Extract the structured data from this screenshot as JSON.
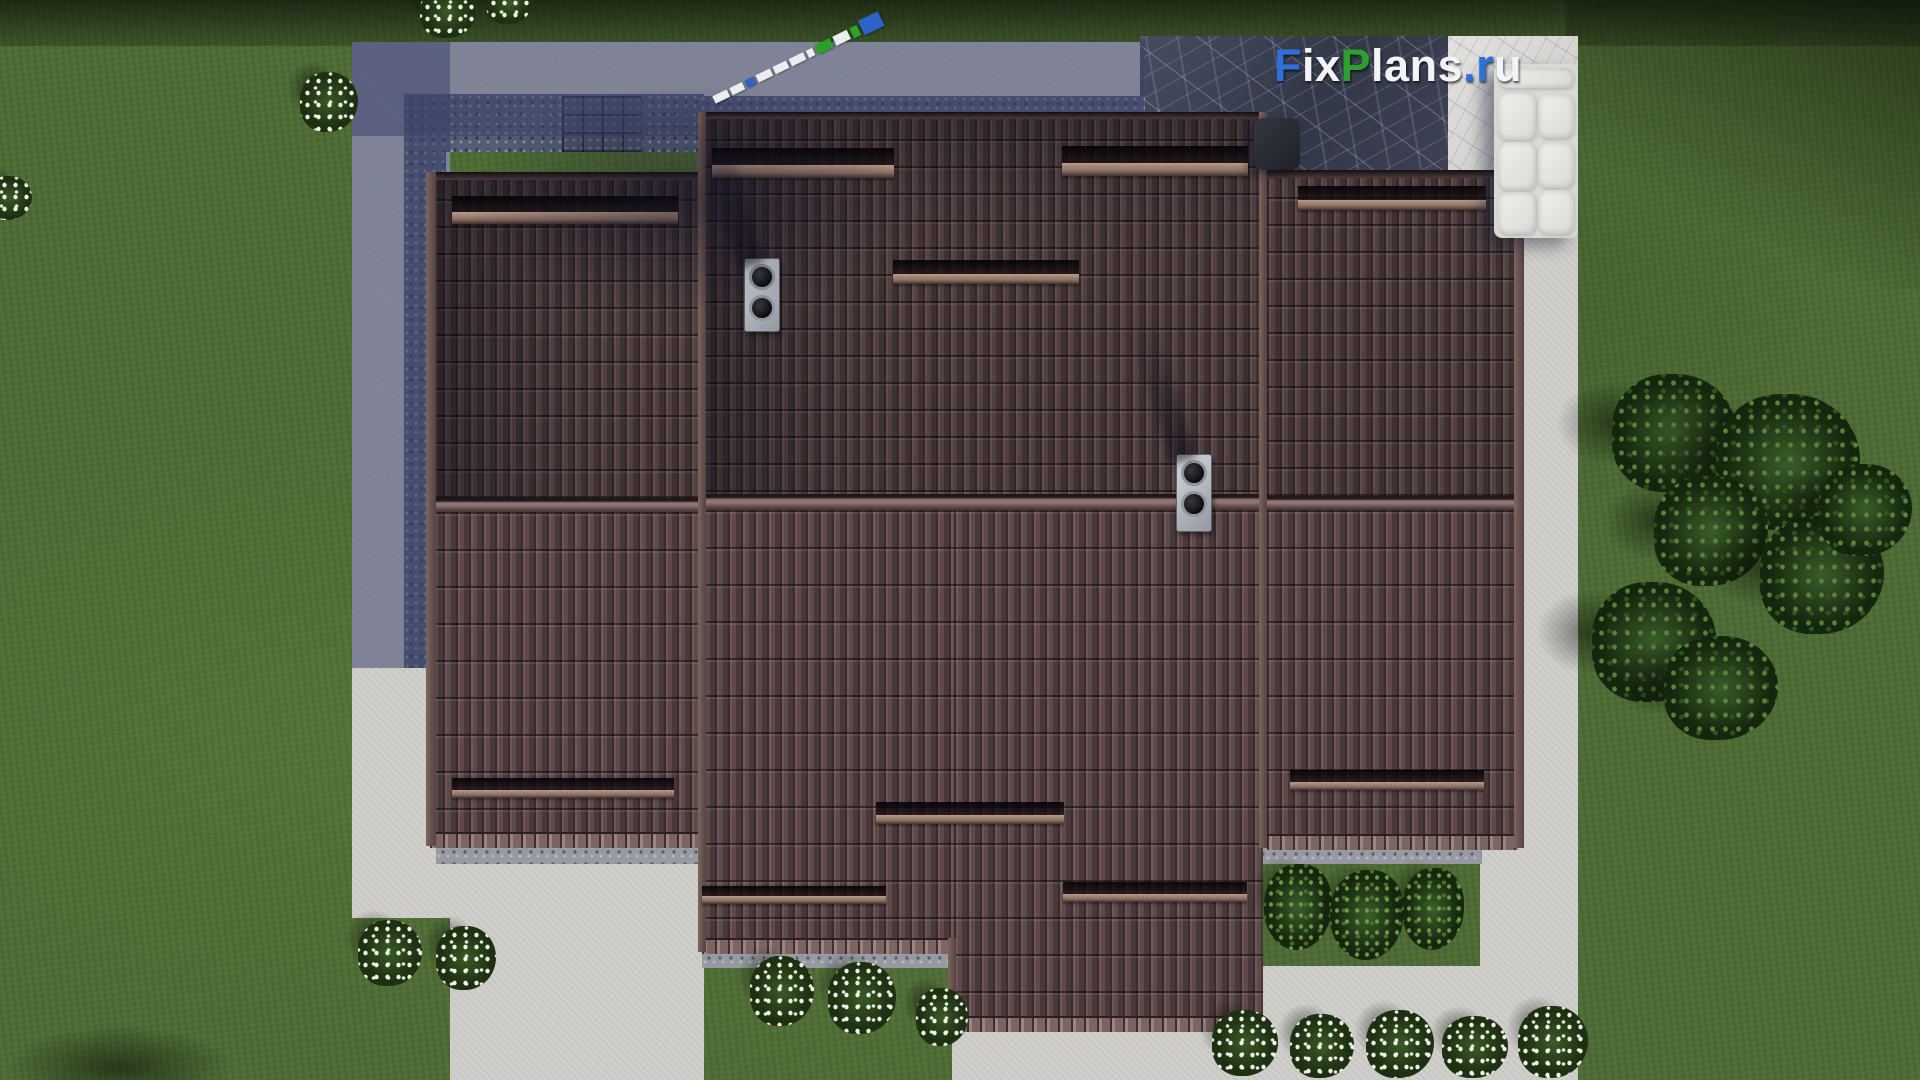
{
  "scene": {
    "description": "Aerial top-down 3D architectural render of a single-family house with a brown tiled hip roof, gray paved terrace and driveway, green lawn, flower bushes and trees",
    "view": "top-down bird's eye"
  },
  "watermark": {
    "text": "FixPlans.ru",
    "segments": [
      {
        "text": "F",
        "color": "#2e6fd8"
      },
      {
        "text": "ix",
        "color": "#f3f4f6"
      },
      {
        "text": "P",
        "color": "#2da02d"
      },
      {
        "text": "lans",
        "color": "#f3f4f6"
      },
      {
        "text": ".",
        "color": "#2e6fd8"
      },
      {
        "text": "r",
        "color": "#2e6fd8"
      },
      {
        "text": "u",
        "color": "#f3f4f6"
      }
    ]
  },
  "ruler": {
    "segments": [
      "white",
      "white",
      "blue",
      "white",
      "white",
      "white",
      "white",
      "green",
      "white",
      "green",
      "blue"
    ]
  },
  "palette": {
    "grass": "#4e6c35",
    "roof_tile": "#5e4a4a",
    "pavement_light": "#cfcecb",
    "pavement_shadow": "#8089a3",
    "slate_dark": "#3d4154",
    "logo_blue": "#2e6fd8",
    "logo_green": "#2da02d"
  },
  "counts": {
    "roof_vents": 2,
    "snow_guards": 10,
    "flower_bushes": 14,
    "green_bushes": 3,
    "trees": 7
  }
}
